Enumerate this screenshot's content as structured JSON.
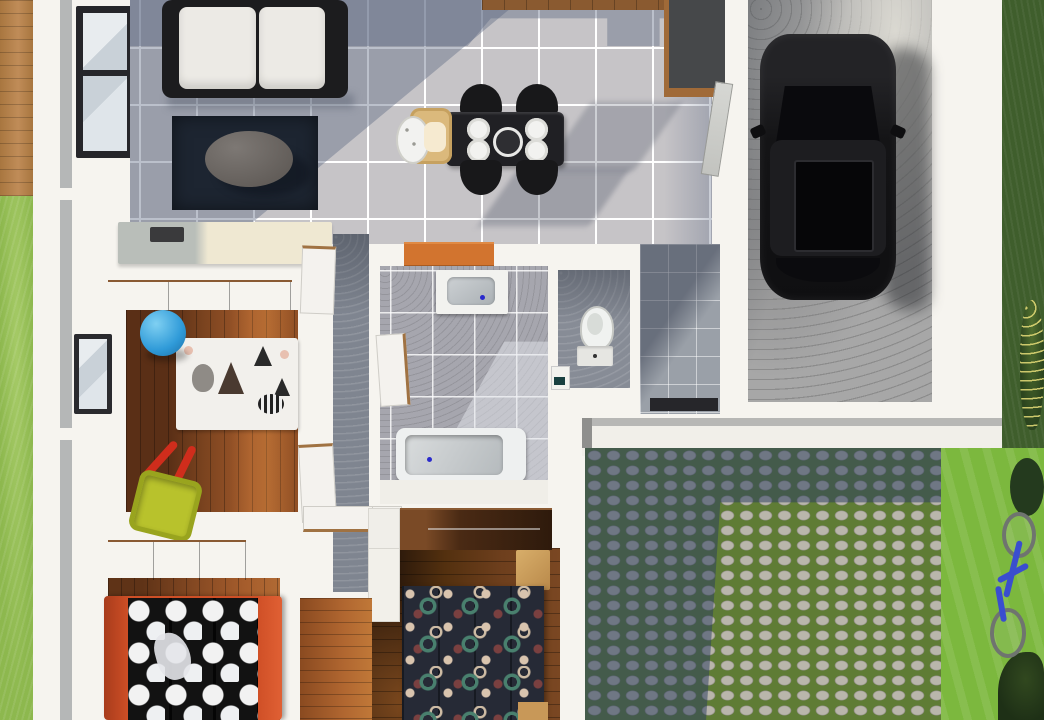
{
  "scene": {
    "type": "3d-floor-plan-top-view",
    "description": "Photorealistic top-down 3D rendering of a house floor plan with attached garage, cobblestone driveway, lawn, wooden deck, open living-dining-kitchen area, kids room, hallway, bathroom, WC, laundry, and two bedrooms",
    "rooms": [
      {
        "id": "living-room"
      },
      {
        "id": "dining-area"
      },
      {
        "id": "kitchen"
      },
      {
        "id": "garage"
      },
      {
        "id": "kids-room"
      },
      {
        "id": "hallway"
      },
      {
        "id": "bathroom"
      },
      {
        "id": "wc"
      },
      {
        "id": "laundry"
      },
      {
        "id": "bedroom-polka"
      },
      {
        "id": "master-bedroom"
      },
      {
        "id": "cobblestone-driveway"
      },
      {
        "id": "garden"
      }
    ],
    "objects": [
      "white-sofa-black-frame",
      "navy-area-rug",
      "oval-coffee-table",
      "cream-sideboard",
      "black-dining-table-four-plates",
      "four-black-chairs",
      "wooden-high-chair",
      "kitchen-counter",
      "tall-gray-cabinet",
      "black-suv-car",
      "concrete-garage-floor",
      "bathtub",
      "sink-vanity",
      "toilet",
      "small-washbasin",
      "orange-kitchen-counter",
      "brown-wardrobes",
      "single-bed-orange-frame-polka-dot-duvet",
      "double-bed-navy-circle-pattern-duvet",
      "light-wood-bench",
      "blue-ball",
      "yellow-red-toy-wheelbarrow",
      "animal-motif-kids-rug",
      "blue-bicycle",
      "bushes",
      "windows-black-frame",
      "wooden-deck"
    ]
  },
  "palette": {
    "wall_white": "#f6f4ef",
    "tile_gray": "#c6c4c7",
    "tile_grout": "#ffffff",
    "shadow_blue": "rgba(94,106,132,0.42)",
    "bath_tile": "#a6a6ae",
    "hall_tile": "#7f8590",
    "wood_floor": "#8a4c24",
    "wood_deck": "#b5824f",
    "wardrobe_brown": "#5d3519",
    "grass_side": "#8db84e",
    "grass_lawn": "#7cb83e",
    "grass_dark": "#3f5e2c",
    "concrete": "#a7a7a7",
    "car_black": "#141416",
    "sofa_white": "#eceae5",
    "sofa_frame": "#1c1c1e",
    "rug_navy": "#1d2531",
    "table_black": "#202024",
    "counter_orange": "#d2742f",
    "bed_frame_orange": "#cf4f26",
    "duvet_black": "#121212",
    "duvet_navy": "#262a36",
    "ball_blue": "#2f9ad8",
    "toy_yellow": "#b8c22c",
    "toy_red": "#cf2d1c",
    "cream_sideboard": "#efe8d2",
    "cobble_stone": "#b9b6ab",
    "moss_green": "#5f7c35",
    "bike_blue": "#3a4ecf",
    "tub_white": "#eef0f0"
  }
}
